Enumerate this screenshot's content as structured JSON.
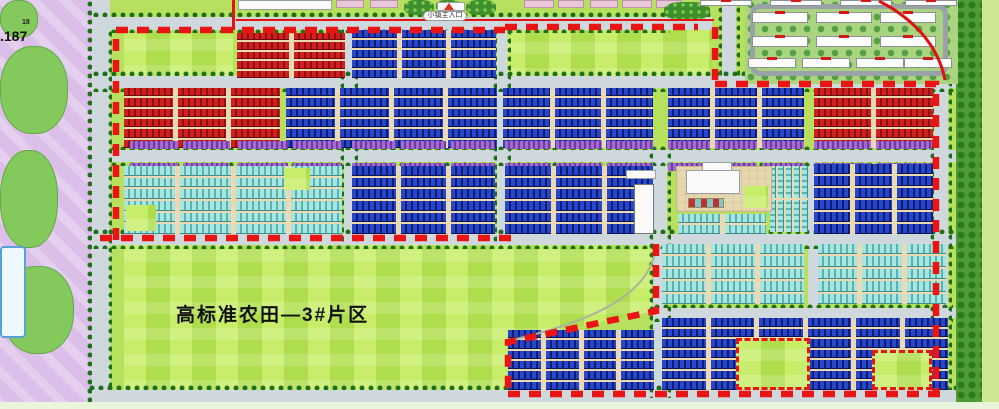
{
  "labels": {
    "farmland_zone": "高标准农田—3#片区",
    "main_entrance": "小镇主入口",
    "elevation": ".187",
    "elevation_small": "18"
  },
  "colors": {
    "boundary_red": "#ea1414",
    "red_roof": "#c81d1d",
    "blue_roof": "#1f3bb0",
    "cyan_roof": "#79ccc8",
    "purple_roof": "#9a5fc8",
    "field_green": "#aede4e",
    "road_gray": "#cfd8dc",
    "park_pink": "#dcbfe9"
  },
  "zones": [
    {
      "name": "map-base",
      "cls": "base",
      "x": 0,
      "y": 0,
      "w": 999,
      "h": 409
    },
    {
      "name": "farmland",
      "cls": "field farmland",
      "x": 124,
      "y": 244,
      "w": 532,
      "h": 148
    },
    {
      "name": "field-a1",
      "cls": "field",
      "x": 124,
      "y": 33,
      "w": 109,
      "h": 44
    },
    {
      "name": "field-a2",
      "cls": "field",
      "x": 503,
      "y": 24,
      "w": 209,
      "h": 56
    },
    {
      "name": "park-strip",
      "cls": "pink",
      "x": 0,
      "y": 0,
      "w": 92,
      "h": 409
    },
    {
      "name": "park-blob-1",
      "cls": "blob",
      "x": 0,
      "y": 46,
      "w": 68,
      "h": 88
    },
    {
      "name": "park-blob-2",
      "cls": "blob",
      "x": 0,
      "y": 150,
      "w": 58,
      "h": 98
    },
    {
      "name": "park-blob-3",
      "cls": "blob",
      "x": 2,
      "y": 266,
      "w": 72,
      "h": 88
    },
    {
      "name": "park-blob-4",
      "cls": "blob",
      "x": 0,
      "y": 0,
      "w": 38,
      "h": 38
    },
    {
      "name": "pool",
      "cls": "pool",
      "x": 0,
      "y": 246,
      "w": 26,
      "h": 92
    },
    {
      "name": "road-left",
      "cls": "road",
      "x": 92,
      "y": 0,
      "w": 18,
      "h": 409
    },
    {
      "name": "road-top",
      "cls": "road",
      "x": 110,
      "y": 17,
      "w": 602,
      "h": 13
    },
    {
      "name": "road-h1",
      "cls": "road",
      "x": 92,
      "y": 76,
      "w": 866,
      "h": 12
    },
    {
      "name": "road-h2",
      "cls": "road",
      "x": 110,
      "y": 150,
      "w": 848,
      "h": 12
    },
    {
      "name": "road-h3",
      "cls": "road",
      "x": 92,
      "y": 234,
      "w": 866,
      "h": 11
    },
    {
      "name": "road-h4",
      "cls": "road",
      "x": 653,
      "y": 308,
      "w": 305,
      "h": 10
    },
    {
      "name": "road-bottom",
      "cls": "road",
      "x": 88,
      "y": 390,
      "w": 911,
      "h": 12
    },
    {
      "name": "road-v3",
      "cls": "road",
      "x": 344,
      "y": 24,
      "w": 10,
      "h": 221
    },
    {
      "name": "road-v4",
      "cls": "road",
      "x": 497,
      "y": 24,
      "w": 10,
      "h": 221
    },
    {
      "name": "road-v5",
      "cls": "road",
      "x": 653,
      "y": 150,
      "w": 14,
      "h": 250
    },
    {
      "name": "road-v6",
      "cls": "road",
      "x": 808,
      "y": 150,
      "w": 10,
      "h": 250
    },
    {
      "name": "road-right",
      "cls": "road",
      "x": 934,
      "y": 76,
      "w": 14,
      "h": 324
    },
    {
      "name": "road-res-access",
      "cls": "road",
      "x": 722,
      "y": 6,
      "w": 14,
      "h": 72
    },
    {
      "name": "tree-row",
      "cls": "trees-h",
      "x": 92,
      "y": 12,
      "w": 620,
      "h": 5
    },
    {
      "name": "tree-row",
      "cls": "trees-h",
      "x": 110,
      "y": 29,
      "w": 560,
      "h": 4
    },
    {
      "name": "tree-row",
      "cls": "trees-h",
      "x": 92,
      "y": 71,
      "w": 866,
      "h": 5
    },
    {
      "name": "tree-row",
      "cls": "trees-h",
      "x": 92,
      "y": 88,
      "w": 866,
      "h": 4
    },
    {
      "name": "tree-row",
      "cls": "trees-h",
      "x": 110,
      "y": 146,
      "w": 824,
      "h": 4
    },
    {
      "name": "tree-row",
      "cls": "trees-h",
      "x": 110,
      "y": 162,
      "w": 824,
      "h": 4
    },
    {
      "name": "tree-row",
      "cls": "trees-h",
      "x": 92,
      "y": 229,
      "w": 866,
      "h": 5
    },
    {
      "name": "tree-row",
      "cls": "trees-h",
      "x": 92,
      "y": 245,
      "w": 862,
      "h": 4
    },
    {
      "name": "tree-row",
      "cls": "trees-h",
      "x": 653,
      "y": 304,
      "w": 300,
      "h": 4
    },
    {
      "name": "tree-row",
      "cls": "trees-h",
      "x": 653,
      "y": 318,
      "w": 300,
      "h": 4
    },
    {
      "name": "tree-row",
      "cls": "trees-h",
      "x": 88,
      "y": 385,
      "w": 911,
      "h": 5
    },
    {
      "name": "tree-row",
      "cls": "trees-h",
      "x": 88,
      "y": 402,
      "w": 911,
      "h": 4
    },
    {
      "name": "tree-row",
      "cls": "trees-v",
      "x": 87,
      "y": 0,
      "w": 5,
      "h": 409
    },
    {
      "name": "tree-row",
      "cls": "trees-v",
      "x": 108,
      "y": 30,
      "w": 4,
      "h": 358
    },
    {
      "name": "tree-row",
      "cls": "trees-v",
      "x": 930,
      "y": 80,
      "w": 4,
      "h": 310
    },
    {
      "name": "tree-row",
      "cls": "trees-v",
      "x": 948,
      "y": 80,
      "w": 4,
      "h": 310
    },
    {
      "name": "tree-row",
      "cls": "trees-v",
      "x": 718,
      "y": 6,
      "w": 4,
      "h": 72
    },
    {
      "name": "tree-row",
      "cls": "trees-v",
      "x": 736,
      "y": 6,
      "w": 4,
      "h": 72
    },
    {
      "name": "tree-row",
      "cls": "trees-v",
      "x": 340,
      "y": 28,
      "w": 4,
      "h": 215
    },
    {
      "name": "tree-row",
      "cls": "trees-v",
      "x": 354,
      "y": 28,
      "w": 4,
      "h": 215
    },
    {
      "name": "tree-row",
      "cls": "trees-v",
      "x": 493,
      "y": 28,
      "w": 4,
      "h": 215
    },
    {
      "name": "tree-row",
      "cls": "trees-v",
      "x": 507,
      "y": 28,
      "w": 4,
      "h": 215
    },
    {
      "name": "tree-row",
      "cls": "trees-v",
      "x": 649,
      "y": 152,
      "w": 4,
      "h": 246
    },
    {
      "name": "tree-row",
      "cls": "trees-v",
      "x": 667,
      "y": 152,
      "w": 4,
      "h": 246
    },
    {
      "name": "greenbelt-right",
      "cls": "trees-band",
      "x": 956,
      "y": 0,
      "w": 26,
      "h": 409
    },
    {
      "name": "edge-lawn",
      "cls": "lawn2",
      "x": 982,
      "y": 0,
      "w": 17,
      "h": 409
    },
    {
      "name": "bottom-strip",
      "cls": "pale",
      "x": 0,
      "y": 402,
      "w": 999,
      "h": 7
    },
    {
      "name": "top-building",
      "cls": "white-b",
      "x": 238,
      "y": 0,
      "w": 94,
      "h": 10
    },
    {
      "name": "top-slab",
      "cls": "pink-slab",
      "x": 336,
      "y": 0,
      "w": 28,
      "h": 8
    },
    {
      "name": "top-slab",
      "cls": "pink-slab",
      "x": 370,
      "y": 0,
      "w": 28,
      "h": 8
    },
    {
      "name": "top-slab",
      "cls": "pink-slab",
      "x": 524,
      "y": 0,
      "w": 30,
      "h": 8
    },
    {
      "name": "top-slab",
      "cls": "pink-slab",
      "x": 558,
      "y": 0,
      "w": 26,
      "h": 8
    },
    {
      "name": "top-slab",
      "cls": "pink-slab",
      "x": 590,
      "y": 0,
      "w": 28,
      "h": 8
    },
    {
      "name": "top-slab",
      "cls": "pink-slab",
      "x": 622,
      "y": 0,
      "w": 30,
      "h": 8
    },
    {
      "name": "top-slab",
      "cls": "pink-slab",
      "x": 656,
      "y": 0,
      "w": 26,
      "h": 8
    },
    {
      "name": "entrance-garden",
      "cls": "garden",
      "x": 404,
      "y": 0,
      "w": 30,
      "h": 15
    },
    {
      "name": "entrance-garden",
      "cls": "garden",
      "x": 436,
      "y": 0,
      "w": 24,
      "h": 12
    },
    {
      "name": "entrance-garden",
      "cls": "garden",
      "x": 466,
      "y": 0,
      "w": 30,
      "h": 15
    },
    {
      "name": "res-garden",
      "cls": "garden",
      "x": 664,
      "y": 2,
      "w": 46,
      "h": 18
    },
    {
      "name": "entrance-gate",
      "cls": "white-b",
      "x": 437,
      "y": 2,
      "w": 28,
      "h": 9
    },
    {
      "name": "red-line-v",
      "cls": "redline",
      "x": 232,
      "y": 0,
      "w": 3,
      "h": 30
    },
    {
      "name": "red-line-h",
      "cls": "redline",
      "x": 236,
      "y": 19,
      "w": 478,
      "h": 2
    },
    {
      "name": "residential-base",
      "cls": "res-base",
      "x": 745,
      "y": 0,
      "w": 213,
      "h": 84
    },
    {
      "name": "residential-loop-road",
      "cls": "loop",
      "x": 750,
      "y": 4,
      "w": 198,
      "h": 72
    }
  ],
  "overlays": [
    {
      "name": "civic-plaza",
      "cls": "plaza",
      "x": 676,
      "y": 166,
      "w": 96,
      "h": 46
    },
    {
      "name": "civic-building",
      "cls": "white-b",
      "x": 686,
      "y": 170,
      "w": 54,
      "h": 24
    },
    {
      "name": "civic-wing",
      "cls": "white-b",
      "x": 702,
      "y": 162,
      "w": 30,
      "h": 9
    },
    {
      "name": "civic-green",
      "cls": "field",
      "x": 744,
      "y": 186,
      "w": 24,
      "h": 22
    },
    {
      "name": "civic-checker",
      "cls": "checker",
      "x": 688,
      "y": 198,
      "w": 36,
      "h": 10
    },
    {
      "name": "exhibition-building",
      "cls": "white-b tall",
      "x": 634,
      "y": 184,
      "w": 20,
      "h": 50
    },
    {
      "name": "exhibition-wing",
      "cls": "white-b",
      "x": 626,
      "y": 170,
      "w": 30,
      "h": 9
    },
    {
      "name": "green-inset-1",
      "cls": "field",
      "x": 126,
      "y": 205,
      "w": 30,
      "h": 26
    },
    {
      "name": "green-inset-2",
      "cls": "field",
      "x": 284,
      "y": 168,
      "w": 26,
      "h": 22
    },
    {
      "name": "green-plot-1",
      "cls": "field plot",
      "x": 736,
      "y": 338,
      "w": 74,
      "h": 52
    },
    {
      "name": "green-plot-2",
      "cls": "field plot",
      "x": 872,
      "y": 350,
      "w": 60,
      "h": 40
    }
  ],
  "blocks": [
    {
      "name": "red-block-group",
      "type": "red",
      "x": 237,
      "y": 33,
      "w": 108,
      "h": 45,
      "rows": 5,
      "cols": 2
    },
    {
      "name": "blue-block-group",
      "type": "blue",
      "x": 352,
      "y": 30,
      "w": 144,
      "h": 48,
      "rows": 5,
      "cols": 3
    },
    {
      "name": "red-block-group",
      "type": "red",
      "x": 124,
      "y": 88,
      "w": 156,
      "h": 60,
      "rows": 6,
      "cols": 3
    },
    {
      "name": "blue-block-group",
      "type": "blue",
      "x": 286,
      "y": 88,
      "w": 211,
      "h": 60,
      "rows": 6,
      "cols": 4
    },
    {
      "name": "blue-block-group",
      "type": "blue",
      "x": 503,
      "y": 88,
      "w": 150,
      "h": 60,
      "rows": 6,
      "cols": 3
    },
    {
      "name": "blue-block-group",
      "type": "blue",
      "x": 668,
      "y": 88,
      "w": 136,
      "h": 60,
      "rows": 6,
      "cols": 3
    },
    {
      "name": "red-block-group",
      "type": "red",
      "x": 814,
      "y": 88,
      "w": 119,
      "h": 60,
      "rows": 6,
      "cols": 2
    },
    {
      "name": "purple-strip",
      "type": "purple",
      "x": 130,
      "y": 141,
      "w": 100,
      "h": 8,
      "rows": 1,
      "cols": 2,
      "nopad": true
    },
    {
      "name": "purple-strip",
      "type": "purple",
      "x": 238,
      "y": 141,
      "w": 104,
      "h": 8,
      "rows": 1,
      "cols": 2,
      "nopad": true
    },
    {
      "name": "purple-strip",
      "type": "purple",
      "x": 352,
      "y": 141,
      "w": 143,
      "h": 8,
      "rows": 1,
      "cols": 3,
      "nopad": true
    },
    {
      "name": "purple-strip",
      "type": "purple",
      "x": 505,
      "y": 141,
      "w": 148,
      "h": 8,
      "rows": 1,
      "cols": 3,
      "nopad": true
    },
    {
      "name": "purple-strip",
      "type": "purple",
      "x": 668,
      "y": 141,
      "w": 136,
      "h": 8,
      "rows": 1,
      "cols": 3,
      "nopad": true
    },
    {
      "name": "purple-strip",
      "type": "purple",
      "x": 814,
      "y": 141,
      "w": 118,
      "h": 8,
      "rows": 1,
      "cols": 2,
      "nopad": true
    },
    {
      "name": "purple-strip",
      "type": "purple",
      "x": 130,
      "y": 163,
      "w": 100,
      "h": 8,
      "rows": 1,
      "cols": 2,
      "nopad": true
    },
    {
      "name": "purple-strip",
      "type": "purple",
      "x": 238,
      "y": 163,
      "w": 104,
      "h": 8,
      "rows": 1,
      "cols": 2,
      "nopad": true
    },
    {
      "name": "purple-strip",
      "type": "purple",
      "x": 352,
      "y": 163,
      "w": 143,
      "h": 8,
      "rows": 1,
      "cols": 3,
      "nopad": true
    },
    {
      "name": "purple-strip",
      "type": "purple",
      "x": 505,
      "y": 163,
      "w": 148,
      "h": 8,
      "rows": 1,
      "cols": 3,
      "nopad": true
    },
    {
      "name": "purple-strip",
      "type": "purple",
      "x": 668,
      "y": 163,
      "w": 136,
      "h": 8,
      "rows": 1,
      "cols": 3,
      "nopad": true
    },
    {
      "name": "purple-strip",
      "type": "purple",
      "x": 814,
      "y": 163,
      "w": 118,
      "h": 8,
      "rows": 1,
      "cols": 2,
      "nopad": true
    },
    {
      "name": "cyan-block-group",
      "type": "cyan",
      "x": 124,
      "y": 166,
      "w": 218,
      "h": 68,
      "rows": 6,
      "cols": 4
    },
    {
      "name": "blue-block-group",
      "type": "blue",
      "x": 352,
      "y": 166,
      "w": 143,
      "h": 68,
      "rows": 6,
      "cols": 3
    },
    {
      "name": "blue-block-group",
      "type": "blue",
      "x": 505,
      "y": 166,
      "w": 148,
      "h": 68,
      "rows": 6,
      "cols": 3
    },
    {
      "name": "blue-block-group",
      "type": "blue",
      "x": 814,
      "y": 164,
      "w": 119,
      "h": 70,
      "rows": 6,
      "cols": 3
    },
    {
      "name": "cyan-block-group",
      "type": "cyan",
      "x": 678,
      "y": 214,
      "w": 88,
      "h": 20,
      "rows": 2,
      "cols": 2
    },
    {
      "name": "cyan-block-group",
      "type": "cyanv",
      "x": 770,
      "y": 166,
      "w": 38,
      "h": 66,
      "rows": 2,
      "cols": 5,
      "gx": 2
    },
    {
      "name": "cyan-block-group",
      "type": "cyan",
      "x": 662,
      "y": 244,
      "w": 142,
      "h": 60,
      "rows": 5,
      "cols": 3
    },
    {
      "name": "cyan-block-group",
      "type": "cyan",
      "x": 818,
      "y": 244,
      "w": 128,
      "h": 60,
      "rows": 5,
      "cols": 3
    },
    {
      "name": "blue-block-group",
      "type": "blue",
      "x": 508,
      "y": 330,
      "w": 146,
      "h": 60,
      "rows": 6,
      "cols": 4
    },
    {
      "name": "blue-block-group",
      "type": "blue",
      "x": 662,
      "y": 318,
      "w": 286,
      "h": 72,
      "rows": 7,
      "cols": 6
    }
  ],
  "residential": {
    "rows": [
      {
        "y": 0,
        "h": 6,
        "w": 52,
        "xs": [
          700,
          770,
          840,
          905
        ]
      },
      {
        "y": 12,
        "h": 11,
        "w": 56,
        "xs": [
          752,
          816,
          880
        ]
      },
      {
        "y": 36,
        "h": 11,
        "w": 56,
        "xs": [
          752,
          816,
          880
        ]
      },
      {
        "y": 58,
        "h": 10,
        "w": 48,
        "xs": [
          748,
          802,
          856,
          904
        ]
      }
    ]
  },
  "boundary": {
    "dashed": [
      "M116 240 V30 H505",
      "M505 27 H698",
      "M715 27 V80",
      "M715 84 H936 V392",
      "M100 238 H515",
      "M656 244 V311 L508 342 V394",
      "M508 394 H948"
    ],
    "solid": [
      "M879 1 C912 18 938 44 945 80"
    ],
    "edge": [
      "M656 246 C652 292 598 320 512 340"
    ]
  }
}
